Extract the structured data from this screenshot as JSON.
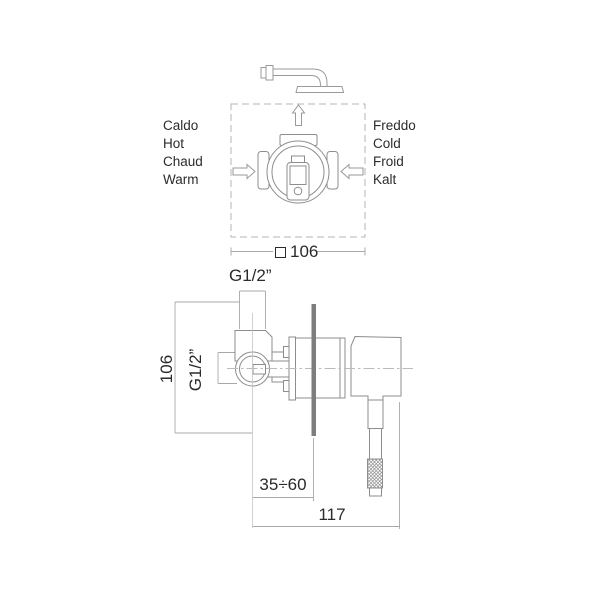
{
  "title": "Concealed shower mixer installation diagram",
  "top_figure": {
    "hot_labels": [
      "Caldo",
      "Hot",
      "Chaud",
      "Warm"
    ],
    "cold_labels": [
      "Freddo",
      "Cold",
      "Froid",
      "Kalt"
    ],
    "square_dim": {
      "symbol": "□",
      "value": "106"
    }
  },
  "bottom_figure": {
    "top_port_label": "G1/2”",
    "side_port_label": "G1/2”",
    "height_label": "106",
    "depth_range_label": "35÷60",
    "width_label": "117"
  },
  "colors": {
    "line": "#8d8d8d",
    "dimension_line": "#a8a8a8",
    "dashed_box": "#b5b5b5",
    "centerline": "#bbbbbb",
    "wall": "#7e7e7e",
    "text": "#2b2b2b"
  }
}
